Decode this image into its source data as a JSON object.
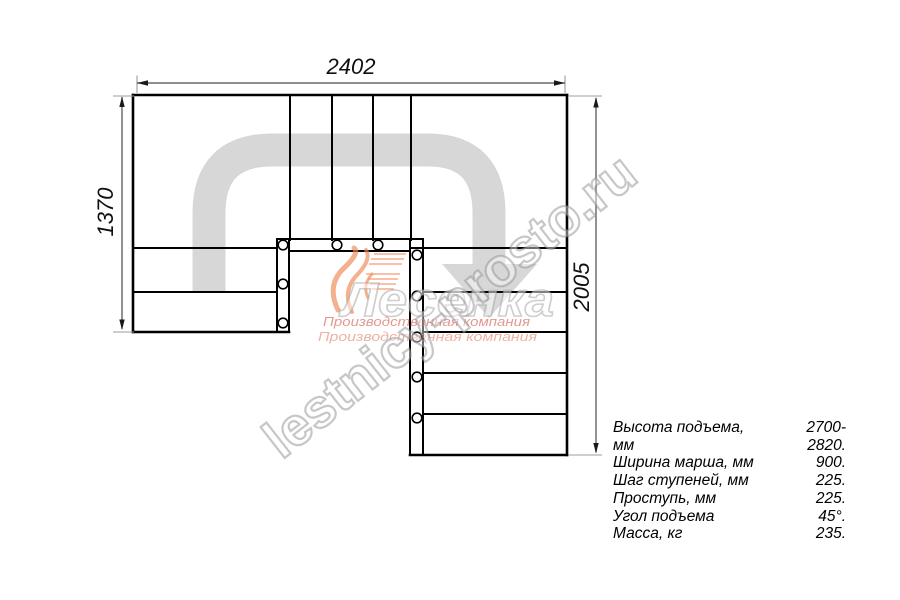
{
  "page": {
    "background": "#ffffff"
  },
  "dimensions": {
    "top": "2402",
    "left": "1370",
    "right": "2005"
  },
  "specs": {
    "rows": [
      {
        "label": "Высота подъема, мм",
        "value": "2700-2820."
      },
      {
        "label": "Ширина марша, мм",
        "value": "900."
      },
      {
        "label": "Шаг ступеней, мм",
        "value": "225."
      },
      {
        "label": "Проступь, мм",
        "value": "225."
      },
      {
        "label": "Угол подъема",
        "value": "45°."
      },
      {
        "label": "Масса, кг",
        "value": "235."
      }
    ]
  },
  "watermarks": {
    "site": "lestnicy-prosto.ru",
    "logo_name": "Лесенка",
    "logo_tagline_1": "Производственная компания",
    "logo_tagline_2": "Производственная компания"
  },
  "colors": {
    "plan_line": "#000000",
    "dimension_line": "#4a4a4a",
    "extension_line": "#9c9c9c",
    "walk_line": "#d7d7d7",
    "logo_orange": "#ee8755",
    "logo_red": "#cc4433"
  }
}
